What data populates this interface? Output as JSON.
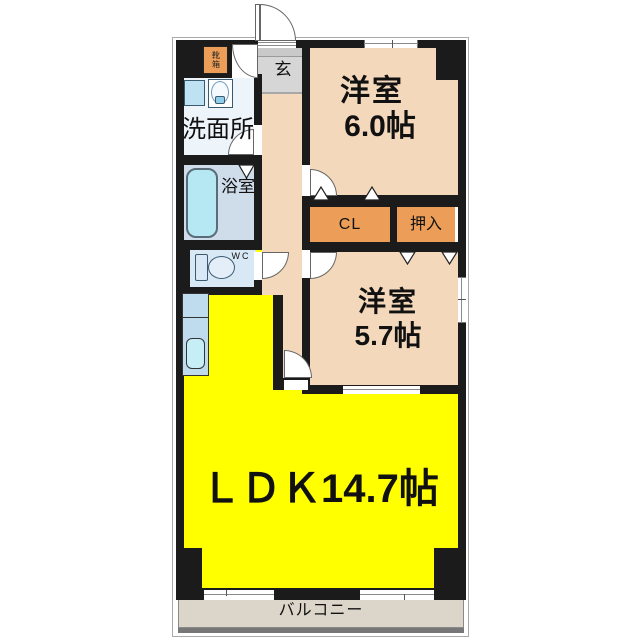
{
  "floorplan": {
    "rooms": {
      "genkan": {
        "label": "玄"
      },
      "shoe_cabinet": {
        "label": "靴箱"
      },
      "washroom": {
        "label": "洗面所"
      },
      "bathroom": {
        "label": "浴室"
      },
      "toilet": {
        "label": "WC"
      },
      "western_room_1": {
        "label": "洋室",
        "size": "6.0帖"
      },
      "closet": {
        "label": "CL"
      },
      "oshiire": {
        "label": "押入"
      },
      "western_room_2": {
        "label": "洋室",
        "size": "5.7帖"
      },
      "ldk": {
        "label": "ＬＤＫ14.7帖"
      },
      "balcony": {
        "label": "バルコニー"
      }
    },
    "colors": {
      "wall": "#1b1b1b",
      "room_peach": "#F4D8BB",
      "closet_orange": "#EC9E58",
      "ldk_yellow": "#FFFF00",
      "genkan_gray": "#D6D6D6",
      "washroom_blue": "#EDF4FA",
      "wc_blue": "#D9E8F5",
      "bath_blue": "#CFDCEA",
      "bathtub_cyan": "#B5E8F2",
      "kitchen_blue": "#BFDCEE",
      "balcony_beige": "#DBD5CA"
    }
  }
}
